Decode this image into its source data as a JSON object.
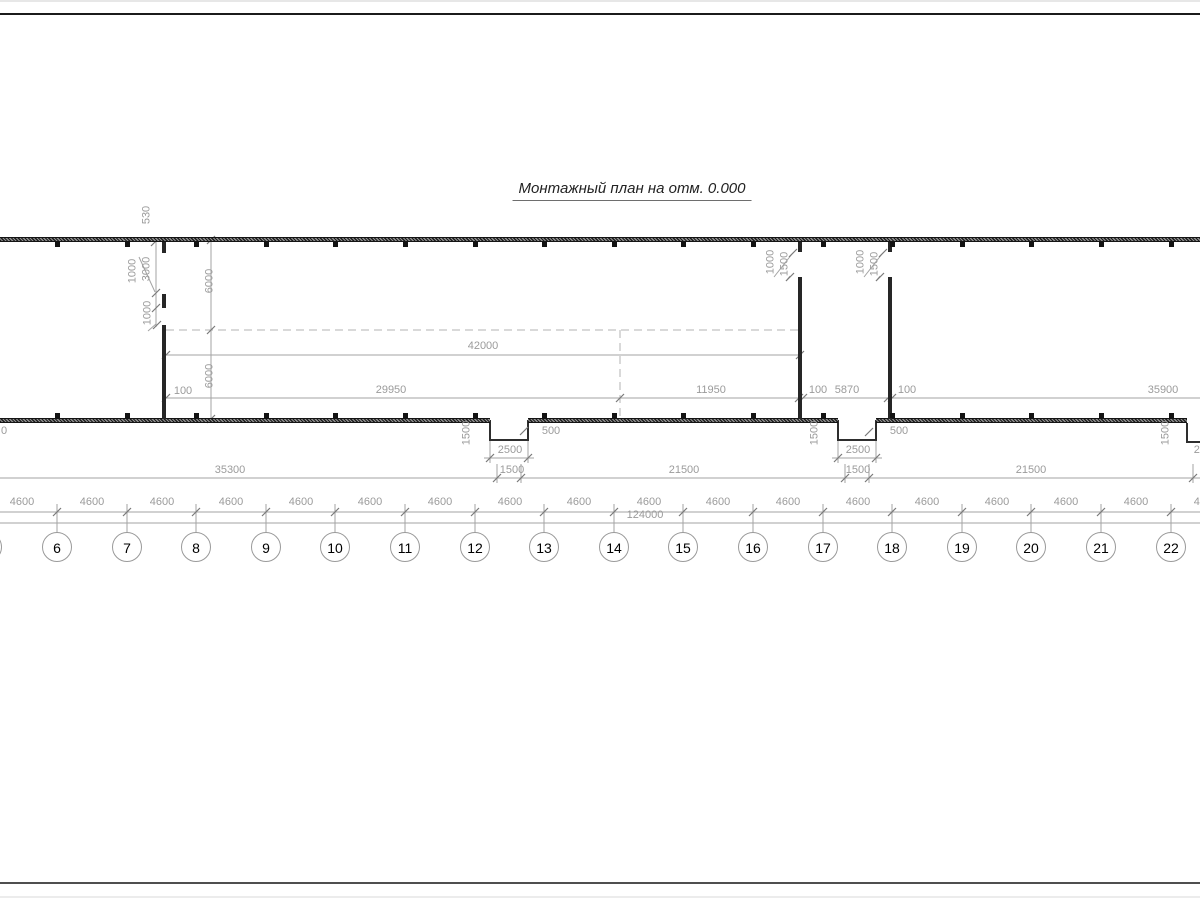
{
  "title": "Монтажный план на отм. 0.000",
  "colors": {
    "dim_line": "#a3a3a3",
    "dim_text": "#9b9b9b",
    "tick": "#7a7a7a",
    "axis_circle": "#9a9a9a",
    "axis_text": "#000000",
    "wall": "#262626"
  },
  "axes": {
    "cy": 547,
    "r": 14.5,
    "bubbles": [
      {
        "label": "",
        "x": -13
      },
      {
        "label": "6",
        "x": 57
      },
      {
        "label": "7",
        "x": 127
      },
      {
        "label": "8",
        "x": 196
      },
      {
        "label": "9",
        "x": 266
      },
      {
        "label": "10",
        "x": 335
      },
      {
        "label": "11",
        "x": 405
      },
      {
        "label": "12",
        "x": 475
      },
      {
        "label": "13",
        "x": 544
      },
      {
        "label": "14",
        "x": 614
      },
      {
        "label": "15",
        "x": 683
      },
      {
        "label": "16",
        "x": 753
      },
      {
        "label": "17",
        "x": 823
      },
      {
        "label": "18",
        "x": 892
      },
      {
        "label": "19",
        "x": 962
      },
      {
        "label": "20",
        "x": 1031
      },
      {
        "label": "21",
        "x": 1101
      },
      {
        "label": "22",
        "x": 1171
      }
    ]
  },
  "bays": {
    "label": "4600",
    "y": 508,
    "centers": [
      22,
      92,
      162,
      231,
      301,
      370,
      440,
      510,
      579,
      649,
      718,
      788,
      858,
      927,
      997,
      1066,
      1136,
      1206
    ]
  },
  "overall": {
    "label": "124000",
    "x": 645,
    "y": 521
  },
  "dim_labels": [
    {
      "t": "42000",
      "x": 483,
      "y": 352
    },
    {
      "t": "100",
      "x": 183,
      "y": 397
    },
    {
      "t": "29950",
      "x": 391,
      "y": 396
    },
    {
      "t": "11950",
      "x": 711,
      "y": 396
    },
    {
      "t": "100",
      "x": 818,
      "y": 396
    },
    {
      "t": "5870",
      "x": 847,
      "y": 396
    },
    {
      "t": "100",
      "x": 907,
      "y": 396
    },
    {
      "t": "35900",
      "x": 1163,
      "y": 396
    },
    {
      "t": "500",
      "x": 551,
      "y": 437
    },
    {
      "t": "2500",
      "x": 510,
      "y": 456
    },
    {
      "t": "500",
      "x": 899,
      "y": 437
    },
    {
      "t": "2500",
      "x": 858,
      "y": 456
    },
    {
      "t": "2500",
      "x": 1206,
      "y": 456
    },
    {
      "t": "0",
      "x": 4,
      "y": 437
    },
    {
      "t": "35300",
      "x": 230,
      "y": 476
    },
    {
      "t": "1500",
      "x": 512,
      "y": 476
    },
    {
      "t": "21500",
      "x": 684,
      "y": 476
    },
    {
      "t": "1500",
      "x": 858,
      "y": 476
    },
    {
      "t": "21500",
      "x": 1031,
      "y": 476
    }
  ],
  "vertical_dim_labels": [
    {
      "t": "530",
      "x": 147,
      "y": 215
    },
    {
      "t": "1000",
      "x": 133,
      "y": 271
    },
    {
      "t": "3000",
      "x": 147,
      "y": 269
    },
    {
      "t": "1000",
      "x": 148,
      "y": 313
    },
    {
      "t": "6000",
      "x": 210,
      "y": 281
    },
    {
      "t": "6000",
      "x": 210,
      "y": 376
    },
    {
      "t": "1000",
      "x": 771,
      "y": 262
    },
    {
      "t": "1500",
      "x": 785,
      "y": 264
    },
    {
      "t": "1000",
      "x": 861,
      "y": 262
    },
    {
      "t": "1500",
      "x": 875,
      "y": 264
    },
    {
      "t": "1500",
      "x": 467,
      "y": 433
    },
    {
      "t": "1500",
      "x": 815,
      "y": 433
    },
    {
      "t": "1500",
      "x": 1166,
      "y": 433
    }
  ]
}
